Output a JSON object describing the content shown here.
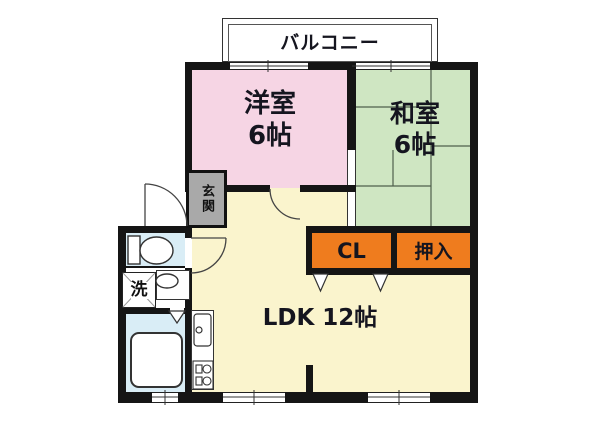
{
  "plan": {
    "balcony_label": "バルコニー",
    "western_room_name": "洋室",
    "western_room_size": "6帖",
    "japanese_room_name": "和室",
    "japanese_room_size": "6帖",
    "entrance_label": "玄関",
    "closet_label": "CL",
    "oshiire_label": "押入",
    "ldk_label": "LDK 12帖",
    "laundry_label": "洗"
  },
  "colors": {
    "western_room_fill": "#f6d5e4",
    "japanese_room_fill": "#cfe6c2",
    "ldk_fill": "#faf4cd",
    "closet_fill": "#ef7c1e",
    "entrance_fill": "#a9a9a9",
    "wet_area_fill": "#d9edf6",
    "wall": "#151515"
  }
}
